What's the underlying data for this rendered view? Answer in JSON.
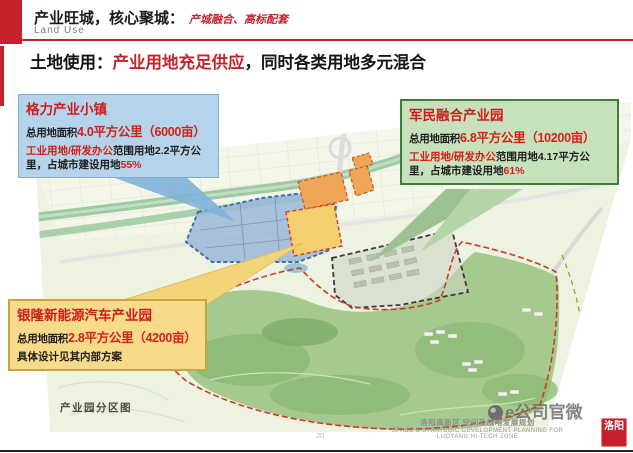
{
  "header": {
    "title": "产业旺城，核心聚城：",
    "subtitle": "产城融合、高标配套",
    "section_en": "Land Use",
    "headline_prefix": "土地使用：",
    "headline_highlight": "产业用地充足供应",
    "headline_suffix": "，同时各类用地多元混合"
  },
  "callouts": {
    "geli": {
      "title": "格力产业小镇",
      "area_label": "总用地面积",
      "area_value": "4.0平方公里（6000亩）",
      "detail_red": "工业用地/研发办公",
      "detail_black": "范围用地2.2平方公里，占城市建设用地",
      "detail_pct": "55%"
    },
    "junmin": {
      "title": "军民融合产业园",
      "area_label": "总用地面积",
      "area_value": "6.8平方公里（10200亩）",
      "detail_red": "工业用地/研发办公",
      "detail_black": "范围用地4.17平方公里，占城市建设用地",
      "detail_pct": "61%"
    },
    "yinlong": {
      "title": "银隆新能源汽车产业园",
      "area_label": "总用地面积",
      "area_value": "2.8平方公里（4200亩）",
      "note": "具体设计见其内部方案"
    }
  },
  "map": {
    "caption": "产业园分区图"
  },
  "footer": {
    "page_number": "20",
    "credit_cn": "洛阳高新区 空间及战略发展规划",
    "credit_en1": "SPACE & STRATEGIC DEVELOPMENT PLANNING FOR",
    "credit_en2": "LUOYANG HI-TECH ZONE",
    "watermark": "e公司官微",
    "seal_text": "洛阳"
  },
  "colors": {
    "accent_red": "#c4232b",
    "value_red": "#d42117",
    "blue_box_bg": "#b5d3ea",
    "green_box_bg": "#c7e1bd",
    "green_box_border": "#3f7d3f",
    "yellow_box_bg": "#f7da8a",
    "yellow_box_border": "#c9a53e"
  }
}
